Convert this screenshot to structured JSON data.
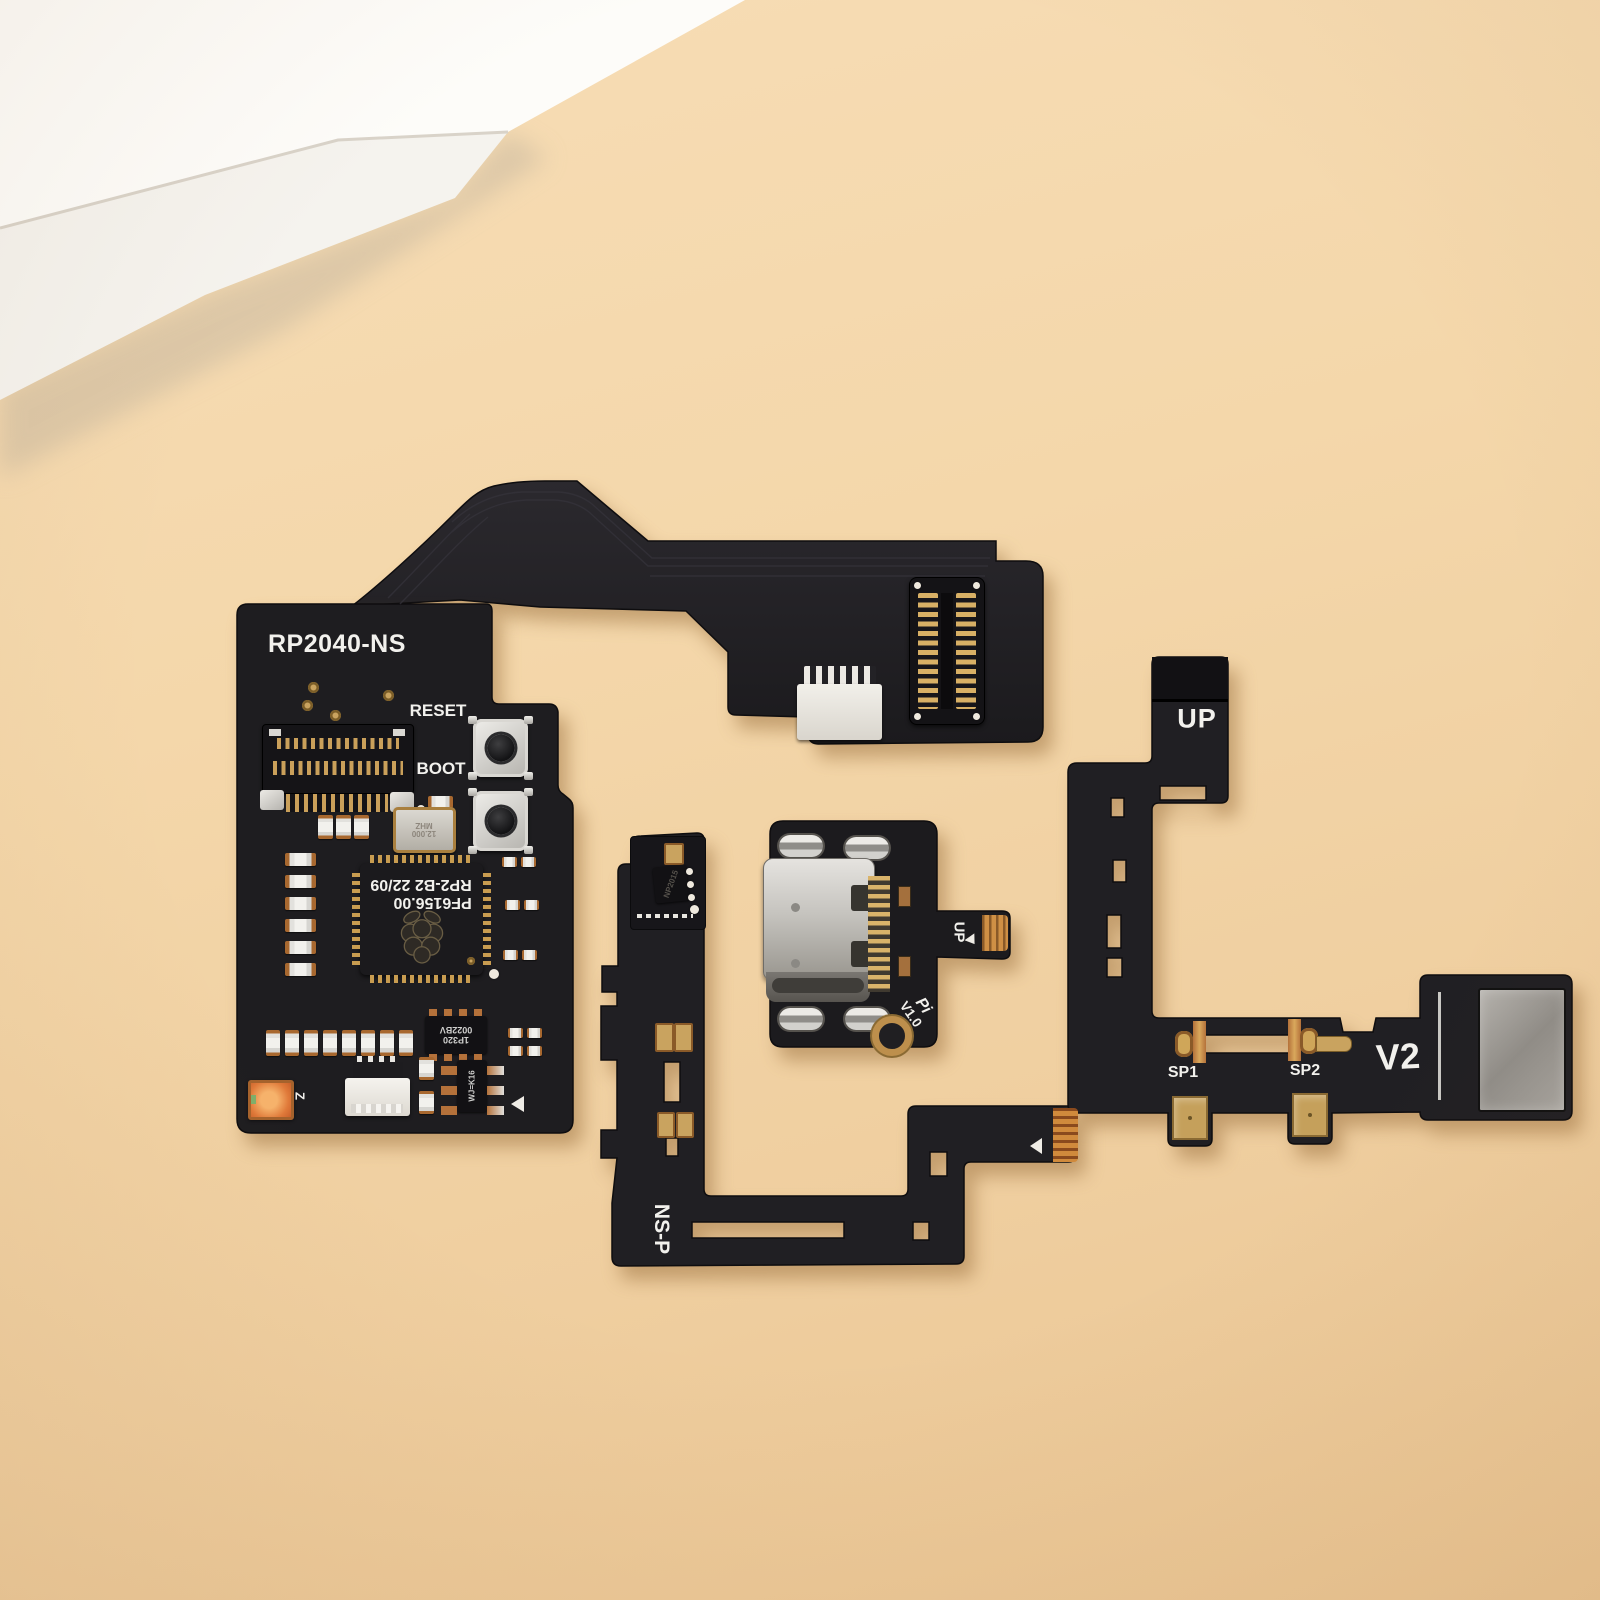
{
  "colors": {
    "background": "#f2d3a6",
    "board_black": "#1d1c1f",
    "gold": "#c9a35f",
    "copper": "#c0762f",
    "silkscreen_white": "#f2f1ed"
  },
  "main_board": {
    "title": "RP2040-NS",
    "reset_label": "RESET",
    "boot_label": "BOOT",
    "crystal_line1": "12.000",
    "crystal_line2": "MHZ",
    "chip_line1": "RP2-B2  22/09",
    "chip_line2": "PF6156.00",
    "ic1_line1": "1P320",
    "ic1_line2": "0022BV",
    "ic2_marking": "WJ=K16",
    "led_marking": "Z"
  },
  "usbc_board": {
    "tail_label": "UP",
    "version_line1": "Pi",
    "version_line2": "V1.0"
  },
  "nsp_cable": {
    "label": "NS-P",
    "ic_marking": "NP2015"
  },
  "v2_cable": {
    "top_label": "UP",
    "version_label": "V2",
    "sp1_label": "SP1",
    "sp2_label": "SP2"
  }
}
